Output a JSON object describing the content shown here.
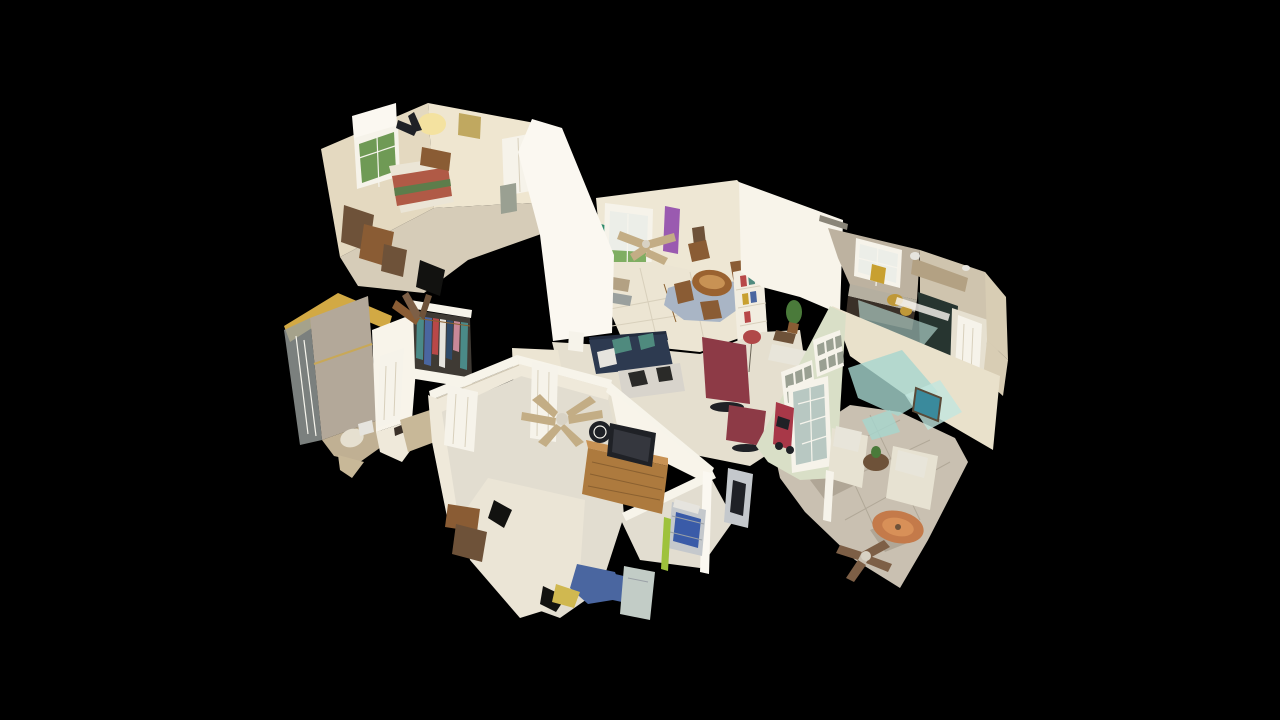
{
  "scene": {
    "type": "3d-dollhouse-view",
    "subject": "single-story house interior 3D scan, overhead cutaway view on black background",
    "background": "#000000",
    "rooms": [
      "guest-bedroom",
      "bathroom",
      "hall-closet",
      "entry-foyer",
      "dining-area",
      "living-room",
      "kitchen",
      "master-bedroom",
      "sunroom"
    ],
    "ceiling_fans": 4
  },
  "colors": {
    "background": "#000000",
    "wall_cream": "#e4d9c0",
    "wall_warm": "#efe6d0",
    "wall_white": "#f8f4ea",
    "wall_bright": "#fbf8f1",
    "wall_face": "#efe9da",
    "wall_north": "#eee7d4",
    "wall_kitchen_left": "#bdb2a0",
    "wall_kitchen_right": "#cfc4ae",
    "wall_kitchen_far": "#d8cdb4",
    "wall_gold": "#d2a944",
    "wall_travertine": "#b3a899",
    "wall_sunroom_gable": "#d9dfc7",
    "wall_sunroom_right": "#e9e1cb",
    "rail_white": "#f7f4ea",
    "floor_carpet": "#d6ccb8",
    "floor_tile": "#ece5d3",
    "floor_living": "#e5dfcf",
    "floor_master": "#e2ddd0",
    "floor_sunroom": "#c9c0b1",
    "floor_bath": "#c0b093",
    "floor_hall": "#c8b898",
    "glass_shower": "#9aa09e",
    "glass_aqua": "#a6d6ce",
    "glass_aqua_light": "#c2e6de",
    "window_green": "#6f9a55",
    "window_light": "#eceee8",
    "pane_inner": "#9aa092",
    "door_white": "#f6f3ea",
    "door_glass": "#b8c8c2",
    "quilt_red": "#b05a46",
    "quilt_green": "#5d7d4b",
    "bed_white": "#ebe5d6",
    "wood_oak": "#ad7a3e",
    "wood_oak_light": "#c89254",
    "wood_brown": "#8a5c34",
    "wood_dark": "#6e5239",
    "wood_dining": "#9a6230",
    "couch_navy": "#2d3a50",
    "couch_navy_dark": "#232c3e",
    "pillow_teal": "#4f8a7e",
    "recliner_red": "#8d3a46",
    "lamp_red": "#b04848",
    "lamp_glow": "#f4e2a0",
    "tv_dark": "#1f2126",
    "tv_screen": "#35373e",
    "fridge_dark": "#273530",
    "cabinet_tan": "#b3a183",
    "cabinet_dark": "#3a3028",
    "counter_gray": "#b5afa0",
    "counter_cream": "#e6e0d0",
    "rug_blue": "#a9b5c5",
    "rug_orange": "#c47a4a",
    "rug_orange_light": "#d89058",
    "fan_blade": "#c3ad85",
    "fan_blade_dark": "#7d5f46",
    "fan_hub": "#d8d2c4",
    "plant_green": "#4a7a3a",
    "closet_dark": "#3f3a34",
    "clothes_teal": "#4a8a88",
    "clothes_blue": "#4a66a0",
    "clothes_red": "#b84848",
    "clothes_white": "#e6e4de",
    "clothes_navy": "#2e4a6a",
    "clothes_pink": "#c88898",
    "scooter_red": "#a83848",
    "crate_blue": "#3a5ba8",
    "chrome": "#c4c8cc",
    "painting_teal": "#3a8a9c",
    "art_purple": "#9a5ab0",
    "wall_teal_glimpse": "#2e8a6a",
    "grass_green": "#7fae62",
    "flowers_yellow": "#c8a030",
    "brass": "#bf9838",
    "cushion_cream": "#e7e2d2",
    "cowhide": "#d8d4cc",
    "cow_patch": "#2a2a28",
    "hole_black": "#121210",
    "throw_yellow": "#d0b850",
    "stick_green": "#9ec23c",
    "marble_patch": "#b0a696",
    "shag_white": "#e8e5da",
    "seat_gray": "#c2ccc6",
    "vent_dark": "#8a8578",
    "picture_gold": "#c0a860",
    "bookshelf_white": "#f2ede0"
  }
}
